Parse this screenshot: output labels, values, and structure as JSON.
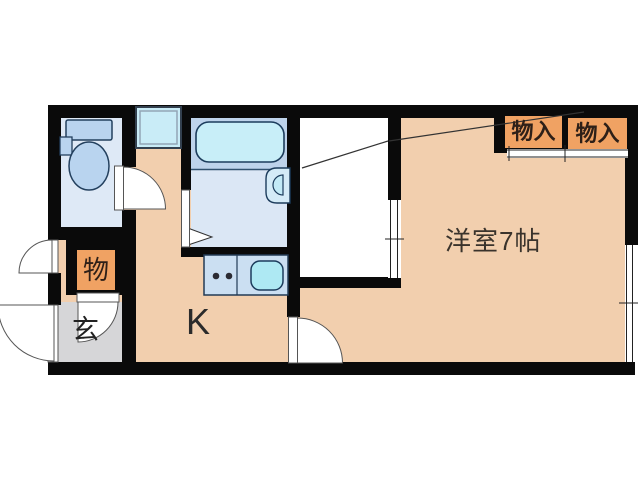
{
  "floor_plan": {
    "title": "apartment-floor-plan-1K",
    "rooms": [
      {
        "id": "western_room",
        "label": "洋室7帖"
      },
      {
        "id": "kitchen",
        "label": "K"
      },
      {
        "id": "entrance",
        "label": "玄"
      },
      {
        "id": "storage",
        "label": "物"
      },
      {
        "id": "closet_1",
        "label": "物入"
      },
      {
        "id": "closet_2",
        "label": "物入"
      }
    ],
    "fixtures": [
      "toilet-icon",
      "toilet-tank",
      "bathtub-icon",
      "washbasin-icon",
      "window-square",
      "kitchen-counter",
      "stove-burners-icon",
      "sink-icon",
      "bath-folding-door-triangle",
      "toilet-door-swing",
      "storage-door-swing",
      "room-door-swing",
      "entrance-door-swing-upper",
      "entrance-door-swing-lower",
      "closet-sliding-door",
      "monoire-sliding-door",
      "right-wall-window",
      "loft-ladder-line"
    ],
    "colors": {
      "wall_black": "#0a0a0a",
      "floor_peach": "#f2cfae",
      "toilet_floor_blue": "#dee9f6",
      "bath_upper_blue": "#bed3eb",
      "bath_lower_blue": "#dbe7f5",
      "fixture_cyan": "#c8eef8",
      "sink_cyan": "#aee9f3",
      "counter_blue": "#cbdff2",
      "tank_blue": "#b9d4ef",
      "storage_orange": "#f0a263",
      "entrance_gray": "#d6d6d8",
      "outline_navy": "#1c3c5c",
      "label_dark": "#2e2018"
    }
  }
}
